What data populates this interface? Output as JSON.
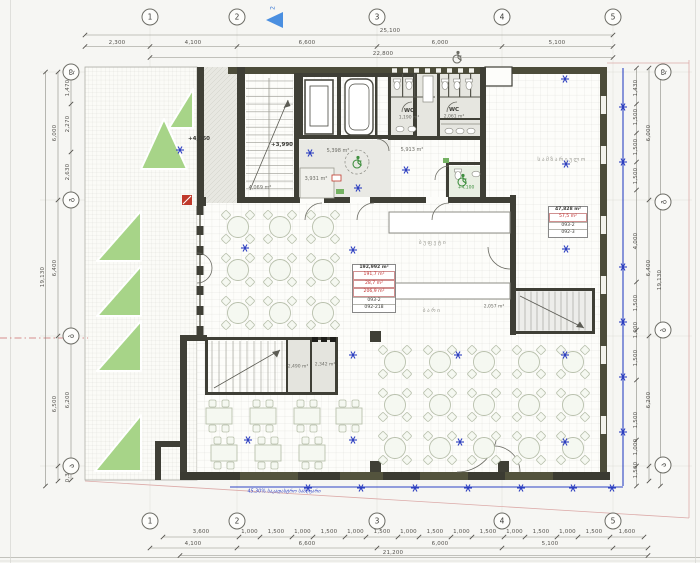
{
  "grid": {
    "top_y": 17,
    "bottom_y": 521,
    "left_x": 71,
    "right_x": 663,
    "top": [
      {
        "label": "1",
        "x": 150
      },
      {
        "label": "2",
        "x": 237
      },
      {
        "label": "3",
        "x": 377
      },
      {
        "label": "4",
        "x": 502
      },
      {
        "label": "5",
        "x": 613
      }
    ],
    "left": [
      {
        "label": "დ",
        "y": 72
      },
      {
        "label": "გ",
        "y": 200
      },
      {
        "label": "ბ",
        "y": 336
      },
      {
        "label": "ა",
        "y": 466
      }
    ],
    "right": [
      {
        "label": "დ",
        "y": 72
      },
      {
        "label": "გ",
        "y": 202
      },
      {
        "label": "ბ",
        "y": 330
      },
      {
        "label": "ა",
        "y": 465
      }
    ]
  },
  "dims": {
    "top": [
      {
        "t": "25,100",
        "x": 390,
        "y": 31
      },
      {
        "t": "2,300",
        "x": 117,
        "y": 43
      },
      {
        "t": "4,100",
        "x": 193,
        "y": 43
      },
      {
        "t": "6,600",
        "x": 307,
        "y": 43
      },
      {
        "t": "6,000",
        "x": 440,
        "y": 43
      },
      {
        "t": "5,100",
        "x": 557,
        "y": 43
      },
      {
        "t": "22,800",
        "x": 383,
        "y": 54
      }
    ],
    "bottom": [
      {
        "t": "4,100",
        "x": 193,
        "y": 544
      },
      {
        "t": "6,600",
        "x": 307,
        "y": 544
      },
      {
        "t": "6,000",
        "x": 440,
        "y": 544
      },
      {
        "t": "5,100",
        "x": 550,
        "y": 544
      },
      {
        "t": "21,200",
        "x": 393,
        "y": 553
      }
    ],
    "bottom_small_y": 532,
    "bottom_small": [
      "3,600",
      "1,000",
      "1,500",
      "1,000",
      "1,500",
      "1,000",
      "1,500",
      "1,000",
      "1,500",
      "1,000",
      "1,500",
      "1,000",
      "1,500",
      "1,000",
      "1,500",
      "1,600"
    ],
    "left": [
      {
        "t": "1,470",
        "x": 68,
        "y": 88
      },
      {
        "t": "2,270",
        "x": 68,
        "y": 124
      },
      {
        "t": "2,630",
        "x": 68,
        "y": 172
      },
      {
        "t": "6,000",
        "x": 55,
        "y": 133
      },
      {
        "t": "6,400",
        "x": 55,
        "y": 268
      },
      {
        "t": "6,200",
        "x": 68,
        "y": 400
      },
      {
        "t": "6,500",
        "x": 55,
        "y": 404
      },
      {
        "t": "0,300",
        "x": 68,
        "y": 474
      },
      {
        "t": "19,130",
        "x": 43,
        "y": 277
      }
    ],
    "right": [
      {
        "t": "1,430",
        "x": 636,
        "y": 88
      },
      {
        "t": "1,500",
        "x": 636,
        "y": 117
      },
      {
        "t": "1,500",
        "x": 636,
        "y": 147
      },
      {
        "t": "1,500",
        "x": 636,
        "y": 176
      },
      {
        "t": "6,000",
        "x": 649,
        "y": 133
      },
      {
        "t": "4,000",
        "x": 636,
        "y": 241
      },
      {
        "t": "1,500",
        "x": 636,
        "y": 303
      },
      {
        "t": "1,000",
        "x": 636,
        "y": 330
      },
      {
        "t": "1,500",
        "x": 636,
        "y": 358
      },
      {
        "t": "6,400",
        "x": 649,
        "y": 268
      },
      {
        "t": "1,500",
        "x": 636,
        "y": 420
      },
      {
        "t": "1,000",
        "x": 636,
        "y": 447
      },
      {
        "t": "1,500",
        "x": 636,
        "y": 470
      },
      {
        "t": "6,200",
        "x": 649,
        "y": 400
      },
      {
        "t": "19,130",
        "x": 660,
        "y": 280
      }
    ]
  },
  "rooms": [
    {
      "t": "+4,060",
      "x": 199,
      "y": 139,
      "c": "lvl"
    },
    {
      "t": "+3,990",
      "x": 282,
      "y": 145,
      "c": "lvl"
    },
    {
      "t": "5,398 m²",
      "x": 338,
      "y": 151,
      "c": "area"
    },
    {
      "t": "3,931 m²",
      "x": 316,
      "y": 179,
      "c": "area"
    },
    {
      "t": "4,069 m²",
      "x": 260,
      "y": 188,
      "c": "area"
    },
    {
      "t": "5,913 m²",
      "x": 412,
      "y": 150,
      "c": "area"
    },
    {
      "t": "WC",
      "x": 409,
      "y": 111,
      "c": "wc"
    },
    {
      "t": "1,190 m²",
      "x": 409,
      "y": 118,
      "c": "tiny"
    },
    {
      "t": "WC",
      "x": 454,
      "y": 110,
      "c": "wc"
    },
    {
      "t": "2,061 m²",
      "x": 454,
      "y": 117,
      "c": "tiny"
    },
    {
      "t": "2,490 m²",
      "x": 298,
      "y": 367,
      "c": "tiny"
    },
    {
      "t": "2,342 m²",
      "x": 325,
      "y": 365,
      "c": "tiny"
    },
    {
      "t": "2,057 m²",
      "x": 494,
      "y": 307,
      "c": "tiny"
    },
    {
      "t": "ბუფეტი",
      "x": 433,
      "y": 243,
      "c": "geo"
    },
    {
      "t": "ბარი",
      "x": 432,
      "y": 311,
      "c": "geo"
    },
    {
      "t": "სამზარეულო",
      "x": 562,
      "y": 160,
      "c": "geo"
    },
    {
      "t": "+4,100",
      "x": 466,
      "y": 188,
      "c": "lvlg"
    }
  ],
  "area_boxes": [
    {
      "x": 352,
      "y": 264,
      "w": 42,
      "lines": [
        {
          "t": "192,992 m²",
          "red": false
        },
        {
          "t": "191,7 m²",
          "red": true
        },
        {
          "t": "28,7 m²",
          "red": true
        },
        {
          "t": "206,9 m²",
          "red": true
        },
        {
          "t": "093-2",
          "red": false
        },
        {
          "t": "092-218",
          "red": false
        }
      ]
    },
    {
      "x": 548,
      "y": 206,
      "w": 38,
      "lines": [
        {
          "t": "47,828 m²",
          "red": false
        },
        {
          "t": "57,5 m²",
          "red": true
        },
        {
          "t": "093-2",
          "red": false
        },
        {
          "t": "092-3",
          "red": false
        }
      ]
    }
  ],
  "annotations": {
    "section_marker": "2",
    "boundary_note": "45,30% საკადასტრო საზღვარი"
  },
  "icons": {
    "entrance": "wheelchair-accessibility",
    "turning_circle": "wheelchair-accessibility",
    "accessible_wc": "wheelchair-accessibility",
    "sprinkler": "sprinkler-asterisk",
    "section_arrow": "section-cut-arrow"
  },
  "colors": {
    "wall": "#3f3f36",
    "wall_olive": "#4c4c3a",
    "green_landscape": "#a7d488",
    "blue_symbol": "#2d3fc0",
    "property_line": "#2d44c4",
    "boundary_pink": "#dcaaa8",
    "red_accent": "#c23030"
  }
}
